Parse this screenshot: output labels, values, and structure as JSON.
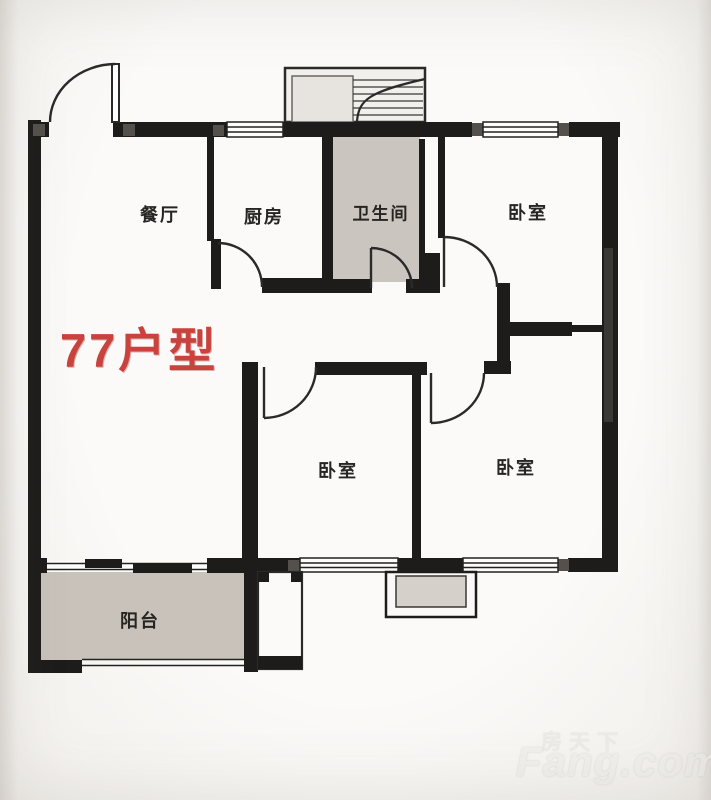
{
  "plan": {
    "title": "77户型"
  },
  "rooms": {
    "dining": {
      "label": "餐厅"
    },
    "kitchen": {
      "label": "厨房"
    },
    "bathroom": {
      "label": "卫生间"
    },
    "bedroom_top_right": {
      "label": "卧室"
    },
    "bedroom_middle": {
      "label": "卧室"
    },
    "bedroom_bottom_right": {
      "label": "卧室"
    },
    "balcony": {
      "label": "阳台"
    }
  },
  "watermark": {
    "cn": "房天下",
    "en": "Fang.com"
  },
  "colors": {
    "wall": "#1d1c1a",
    "wet_room_fill": "#cbc5bf",
    "balcony_fill": "#c8c2bb",
    "title_red": "#c9423d",
    "background": "#f6f4f1"
  }
}
